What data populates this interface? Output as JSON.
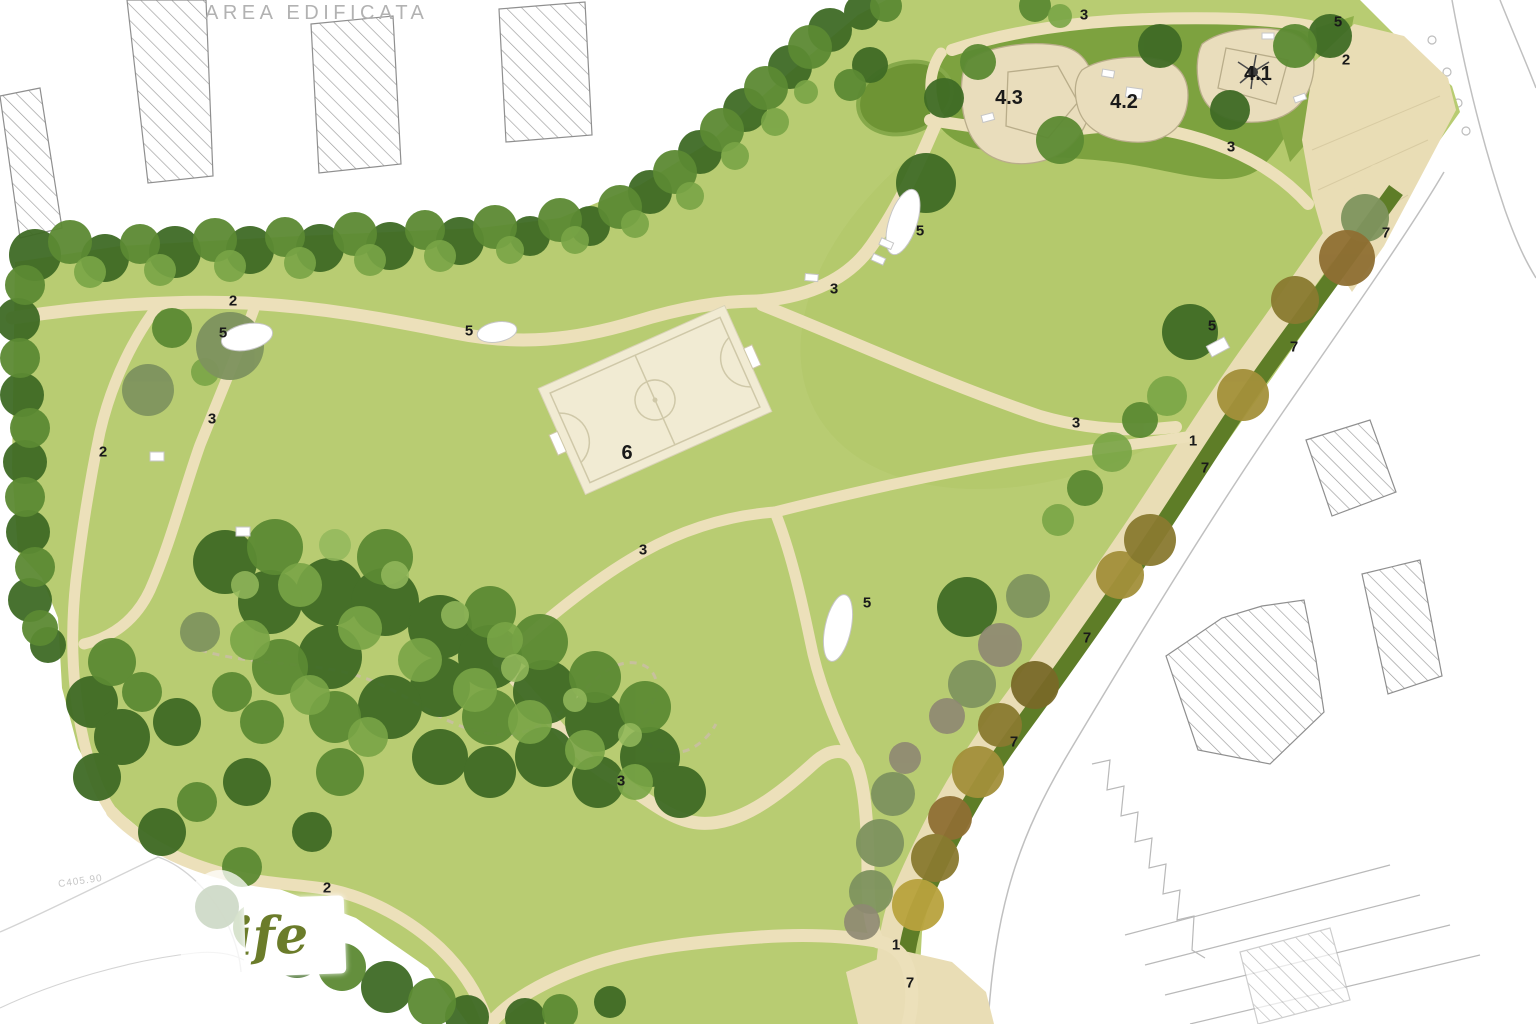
{
  "plan": {
    "area_label": "AREA EDIFICATA",
    "elevation_label": "C405.90",
    "watermark_text": "ife"
  },
  "markers": [
    {
      "label": "3",
      "x": 1084,
      "y": 15
    },
    {
      "label": "5",
      "x": 1338,
      "y": 22
    },
    {
      "label": "2",
      "x": 1346,
      "y": 60
    },
    {
      "label": "4.1",
      "x": 1258,
      "y": 74,
      "size": "lg"
    },
    {
      "label": "4.3",
      "x": 1009,
      "y": 98,
      "size": "lg"
    },
    {
      "label": "4.2",
      "x": 1124,
      "y": 102,
      "size": "lg"
    },
    {
      "label": "3",
      "x": 1231,
      "y": 147
    },
    {
      "label": "7",
      "x": 1386,
      "y": 233
    },
    {
      "label": "5",
      "x": 920,
      "y": 231
    },
    {
      "label": "3",
      "x": 834,
      "y": 289
    },
    {
      "label": "2",
      "x": 233,
      "y": 301
    },
    {
      "label": "5",
      "x": 223,
      "y": 333
    },
    {
      "label": "5",
      "x": 469,
      "y": 331
    },
    {
      "label": "5",
      "x": 1212,
      "y": 326
    },
    {
      "label": "7",
      "x": 1294,
      "y": 347
    },
    {
      "label": "3",
      "x": 212,
      "y": 419
    },
    {
      "label": "2",
      "x": 103,
      "y": 452
    },
    {
      "label": "3",
      "x": 1076,
      "y": 423
    },
    {
      "label": "1",
      "x": 1193,
      "y": 441
    },
    {
      "label": "6",
      "x": 627,
      "y": 453,
      "size": "lg"
    },
    {
      "label": "7",
      "x": 1205,
      "y": 468
    },
    {
      "label": "3",
      "x": 643,
      "y": 550
    },
    {
      "label": "5",
      "x": 867,
      "y": 603
    },
    {
      "label": "7",
      "x": 1087,
      "y": 638
    },
    {
      "label": "3",
      "x": 621,
      "y": 781
    },
    {
      "label": "7",
      "x": 1014,
      "y": 742
    },
    {
      "label": "2",
      "x": 327,
      "y": 888
    },
    {
      "label": "1",
      "x": 896,
      "y": 945
    },
    {
      "label": "7",
      "x": 910,
      "y": 983
    }
  ],
  "colors": {
    "lawn": "#b8cc72",
    "path": "#ece0ba",
    "avenue": "#e9ddb5",
    "playground_green": "#7da23f",
    "hedge": "#5e7d27",
    "field": "#f1ebd3",
    "pad": "#e9ddbc",
    "tree_dark": "#3f6b25",
    "tree_mid": "#5c8a33",
    "tree_light": "#79a546",
    "autumn": "#a3903a",
    "watermark_text": "#6b7c2a",
    "marker_text": "#191919",
    "building_hatch": "#9a9a9a",
    "area_label": "#b2b2b2"
  }
}
